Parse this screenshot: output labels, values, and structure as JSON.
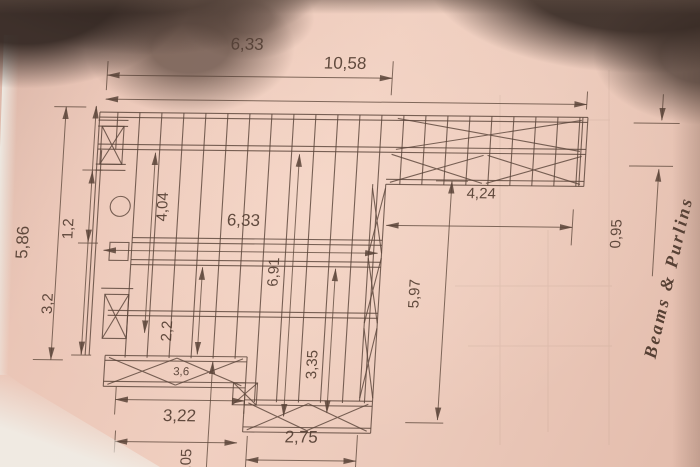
{
  "colors": {
    "paper": "#ecc9ba",
    "ink": "#6b564b",
    "shadow": "#4a3a32"
  },
  "dimensions": {
    "top_main": "6,33",
    "top_total": "10,58",
    "left_total": "5,86",
    "left_upper": "1,2",
    "left_lower": "3,2",
    "inner_left_height": "4,04",
    "inner_width": "6,33",
    "inner_mid_height": "6,91",
    "inner_small_height": "2,2",
    "inner_lower_height": "3,35",
    "arm_width": "4,24",
    "arm_depth": "0,95",
    "right_height": "5,97",
    "bottom_left_width": "3,22",
    "bottom_mid_width": "2,75",
    "bottom_cut_height": "1,05",
    "band_small": "3,6"
  },
  "annotation": {
    "text": "Beams & Purlins"
  }
}
